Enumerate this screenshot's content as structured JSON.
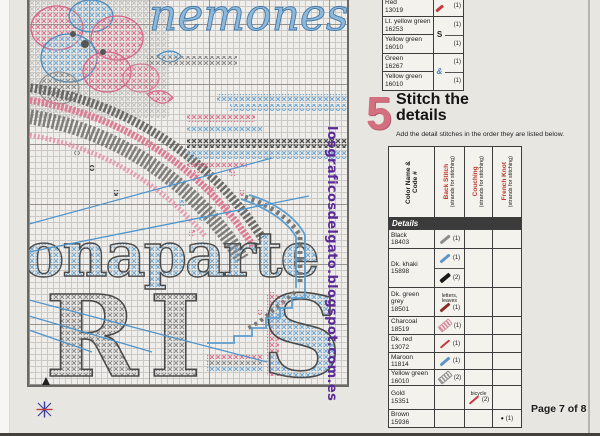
{
  "page": {
    "footer": "Page 7 of 8"
  },
  "watermark": "losgraficosdelgato.blogspot.com.es",
  "step": {
    "number": "5",
    "title_line1": "Stitch the",
    "title_line2": "details",
    "subtitle": "Add the detail stitches in the order they are listed below."
  },
  "color_key": {
    "groups": [
      {
        "symbol": "",
        "entries": [
          {
            "name": "Red",
            "code": "13019",
            "strands": "(1)"
          }
        ]
      },
      {
        "symbol": "S",
        "entries": [
          {
            "name": "Lt. yellow green",
            "code": "16253",
            "strands": "(1)"
          },
          {
            "name": "Yellow green",
            "code": "16010",
            "strands": "(1)"
          }
        ]
      },
      {
        "symbol": "&",
        "entries": [
          {
            "name": "Green",
            "code": "16267",
            "strands": "(1)"
          },
          {
            "name": "Yellow green",
            "code": "16010",
            "strands": "(1)"
          }
        ]
      }
    ]
  },
  "details_table": {
    "header": {
      "name_line1": "Color Name &",
      "name_line2": "Code #",
      "back_label": "Back Stitch",
      "couching_label": "Couching",
      "french_label": "French Knot",
      "sub": "(strands for stitching)"
    },
    "section_label": "Details",
    "rows": [
      {
        "name": "Black",
        "code": "18403",
        "strands": "(1)"
      },
      {
        "name": "Dk. khaki",
        "code": "15898",
        "strands_a": "(1)",
        "strands_b": "(2)"
      },
      {
        "name": "Dk. green grey",
        "code": "18501",
        "note": "letters, leaves",
        "strands": "(1)"
      },
      {
        "name": "Charcoal",
        "code": "18519",
        "strands": "(1)"
      },
      {
        "name": "Dk. red",
        "code": "13072",
        "strands": "(1)"
      },
      {
        "name": "Maroon",
        "code": "11814",
        "strands": "(1)"
      },
      {
        "name": "Yellow green",
        "code": "16010",
        "strands": "(2)"
      },
      {
        "name": "Gold",
        "code": "15351",
        "note": "bicycle",
        "strands": "(2)"
      },
      {
        "name": "Brown",
        "code": "15936",
        "knot_symbol": "•",
        "strands": "(1)"
      }
    ]
  },
  "chart": {
    "script_text": "nemones",
    "letter_b": "B",
    "word": "onaparte",
    "letter_r": "R",
    "letter_i": "I",
    "letter_s": "S"
  },
  "colors": {
    "accent_pink": "#d2707f",
    "header_red": "#c0392b",
    "watermark_purple": "#5b2a96",
    "symbol_pink": "#e0708a",
    "symbol_blue": "#6fa8d2"
  }
}
